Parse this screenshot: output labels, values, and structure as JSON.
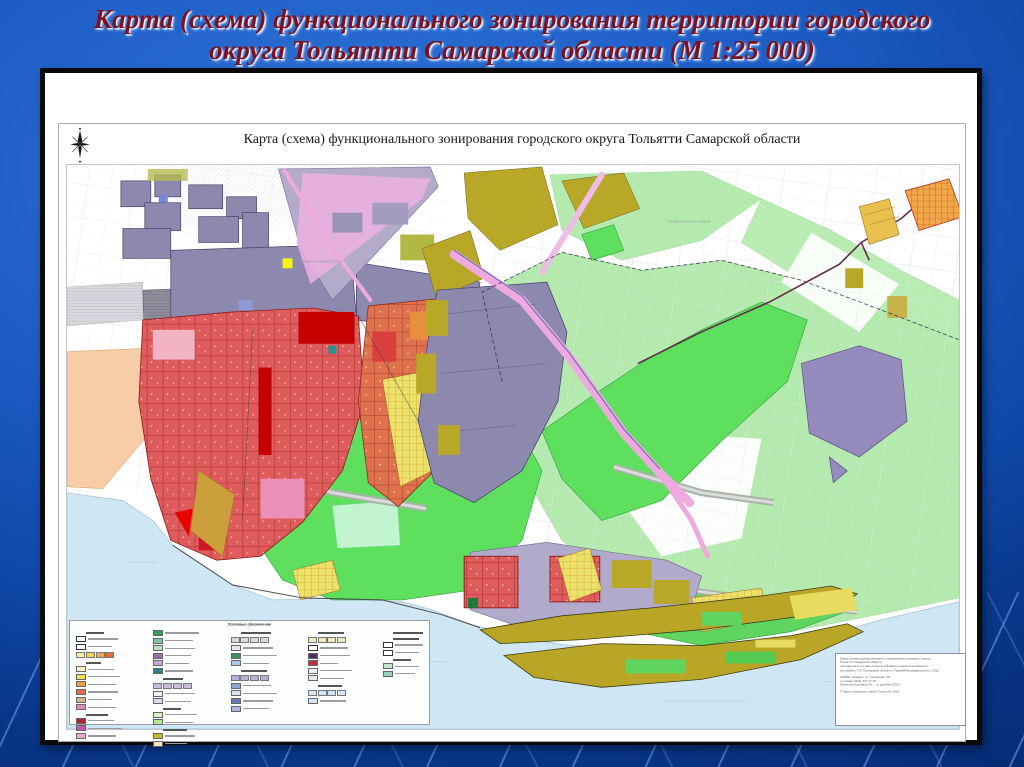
{
  "slide": {
    "title_line1": "Карта (схема) функционального зонирования территории городского",
    "title_line2": "округа Тольятти Самарской области (М 1:25 000)",
    "title_color": "#7c1220",
    "background_color": "#1d5ec6"
  },
  "page": {
    "map_title": "Карта (схема) функционального зонирования  городского округа Тольятти Самарской области",
    "region_labels": [
      "Ставропольский район",
      "Ставропольский район"
    ]
  },
  "legend": {
    "title": "Условные обозначения",
    "columns": [
      [
        {
          "k": "hdr",
          "w": 18
        },
        {
          "k": "row",
          "c": "#ffffff",
          "w": 30,
          "o": true
        },
        {
          "k": "row",
          "c": "#ffffff",
          "w": 24,
          "o": true
        },
        {
          "k": "strip",
          "c": [
            "#f7ef9e",
            "#f2d24b",
            "#eda94c",
            "#e2703a"
          ]
        },
        {
          "k": "hdr",
          "w": 15
        },
        {
          "k": "row",
          "c": "#f9f3c0",
          "w": 26
        },
        {
          "k": "row",
          "c": "#f3e04e",
          "w": 32
        },
        {
          "k": "row",
          "c": "#eca04a",
          "w": 28
        },
        {
          "k": "row",
          "c": "#e06a49",
          "w": 30
        },
        {
          "k": "row",
          "c": "#d8b48a",
          "w": 24
        },
        {
          "k": "row",
          "c": "#e08ab8",
          "w": 28
        },
        {
          "k": "hdr",
          "w": 22
        },
        {
          "k": "row",
          "c": "#b02430",
          "w": 26
        },
        {
          "k": "row",
          "c": "#c05ab0",
          "w": 34
        },
        {
          "k": "row",
          "c": "#f0a8c8",
          "w": 28
        }
      ],
      [
        {
          "k": "row",
          "c": "#3a9e5f",
          "w": 34
        },
        {
          "k": "row",
          "c": "#7fc79a",
          "w": 28
        },
        {
          "k": "row",
          "c": "#b7e0c6",
          "w": 30
        },
        {
          "k": "row",
          "c": "#9b6fae",
          "w": 26
        },
        {
          "k": "row",
          "c": "#c7a8d4",
          "w": 24
        },
        {
          "k": "row",
          "c": "#2e7f86",
          "w": 28
        },
        {
          "k": "hdr",
          "w": 20
        },
        {
          "k": "strip",
          "c": [
            "#cabcdc",
            "#cabcdc",
            "#cabcdc",
            "#cabcdc"
          ]
        },
        {
          "k": "row",
          "c": "#efeef6",
          "w": 30
        },
        {
          "k": "row",
          "c": "#dcd4ea",
          "w": 26
        },
        {
          "k": "hdr",
          "w": 18
        },
        {
          "k": "row",
          "c": "#d8f2c8",
          "w": 32
        },
        {
          "k": "row",
          "c": "#aee89a",
          "w": 28
        },
        {
          "k": "hdr",
          "w": 24
        },
        {
          "k": "row",
          "c": "#c8bb2d",
          "w": 30
        },
        {
          "k": "row",
          "c": "#efe9b4",
          "w": 22
        }
      ],
      [
        {
          "k": "hdr",
          "w": 30
        },
        {
          "k": "strip",
          "c": [
            "#d9d9d9",
            "#d9d9d9",
            "#d9d9d9",
            "#d9d9d9"
          ]
        },
        {
          "k": "row",
          "c": "#e8e8e8",
          "w": 30
        },
        {
          "k": "row",
          "c": "#3f8f5f",
          "w": 34
        },
        {
          "k": "row",
          "c": "#a8c8e8",
          "w": 26
        },
        {
          "k": "hdr",
          "w": 26
        },
        {
          "k": "strip",
          "c": [
            "#b8b0d8",
            "#b8b0d8",
            "#b8b0d8",
            "#b8b0d8"
          ]
        },
        {
          "k": "row",
          "c": "#8fa8d8",
          "w": 28
        },
        {
          "k": "row",
          "c": "#d8e4f4",
          "w": 34
        },
        {
          "k": "row",
          "c": "#6878c0",
          "w": 30
        },
        {
          "k": "row",
          "c": "#b0b8e0",
          "w": 26
        }
      ],
      [
        {
          "k": "hdr",
          "w": 26
        },
        {
          "k": "strip",
          "c": [
            "#efe9c0",
            "#efe9c0",
            "#efe9c0",
            "#efe9c0"
          ]
        },
        {
          "k": "row",
          "c": "#ffffff",
          "w": 28,
          "o": true
        },
        {
          "k": "row",
          "c": "#5a2a62",
          "w": 30
        },
        {
          "k": "row",
          "c": "#c03038",
          "w": 18
        },
        {
          "k": "row",
          "c": "#f0f0f0",
          "w": 32
        },
        {
          "k": "row",
          "c": "#e8e8f0",
          "w": 24
        },
        {
          "k": "hdr",
          "w": 24
        },
        {
          "k": "strip",
          "c": [
            "#cfe7f7",
            "#cfe7f7",
            "#cfe7f7",
            "#cfe7f7"
          ]
        },
        {
          "k": "row",
          "c": "#cfe7f7",
          "w": 26
        }
      ],
      [
        {
          "k": "hdr",
          "w": 30
        },
        {
          "k": "hdr",
          "w": 26
        },
        {
          "k": "row",
          "c": "#ffffff",
          "w": 28,
          "o": true
        },
        {
          "k": "row",
          "c": "#ffffff",
          "w": 24,
          "o": true
        },
        {
          "k": "hdr",
          "w": 18
        },
        {
          "k": "row",
          "c": "#bfe8c8",
          "w": 24
        },
        {
          "k": "row",
          "c": "#8fd8b8",
          "w": 20
        }
      ]
    ]
  },
  "stamp": {
    "lines": [
      "Карта (схема) функционального зонирования городского округа",
      "Тольятти Самарской области",
      "составлена в составе проекта «Правила землепользования и",
      "застройки» ГУП Самарской области «ТеррНИИгражданпроект», 2016",
      "",
      "443096, Самара, ул. Скляренко, 35",
      "тел./факс (846) 337-17-67",
      "Проектный договор № ... от декабря 2015 г.",
      "",
      "© Карта городского округа Тольятти, 2016"
    ]
  },
  "map": {
    "zone_palette": [
      {
        "name": "жилая зона (среднеэтажная застройка)",
        "color": "#df5858"
      },
      {
        "name": "жилая зона (многоэтажная застройка)",
        "color": "#c60000"
      },
      {
        "name": "общественно-деловая зона",
        "color": "#f2b4c4"
      },
      {
        "name": "производственная зона (промузел ВАЗ)",
        "color": "#8d89ae"
      },
      {
        "name": "производственная зона (Центральный район)",
        "color": "#948abb"
      },
      {
        "name": "зона транспортной инфраструктуры",
        "color": "#eeaade"
      },
      {
        "name": "городские леса",
        "color": "#5ee05e"
      },
      {
        "name": "леса пригородные",
        "color": "#b5eaaf"
      },
      {
        "name": "сады и дачи",
        "color": "#ece26a"
      },
      {
        "name": "зона сельскохозяйственного использования",
        "color": "#f6cda6"
      },
      {
        "name": "зона специального назначения",
        "color": "#b9a626"
      },
      {
        "name": "посёлки (Поволжский)",
        "color": "#f0a84a"
      },
      {
        "name": "акватория (Волга)",
        "color": "#cfe6f4"
      },
      {
        "name": "коммунально-складская зона",
        "color": "#8e8e9c"
      },
      {
        "name": "рекреационная зона",
        "color": "#c2f5cf"
      }
    ]
  }
}
